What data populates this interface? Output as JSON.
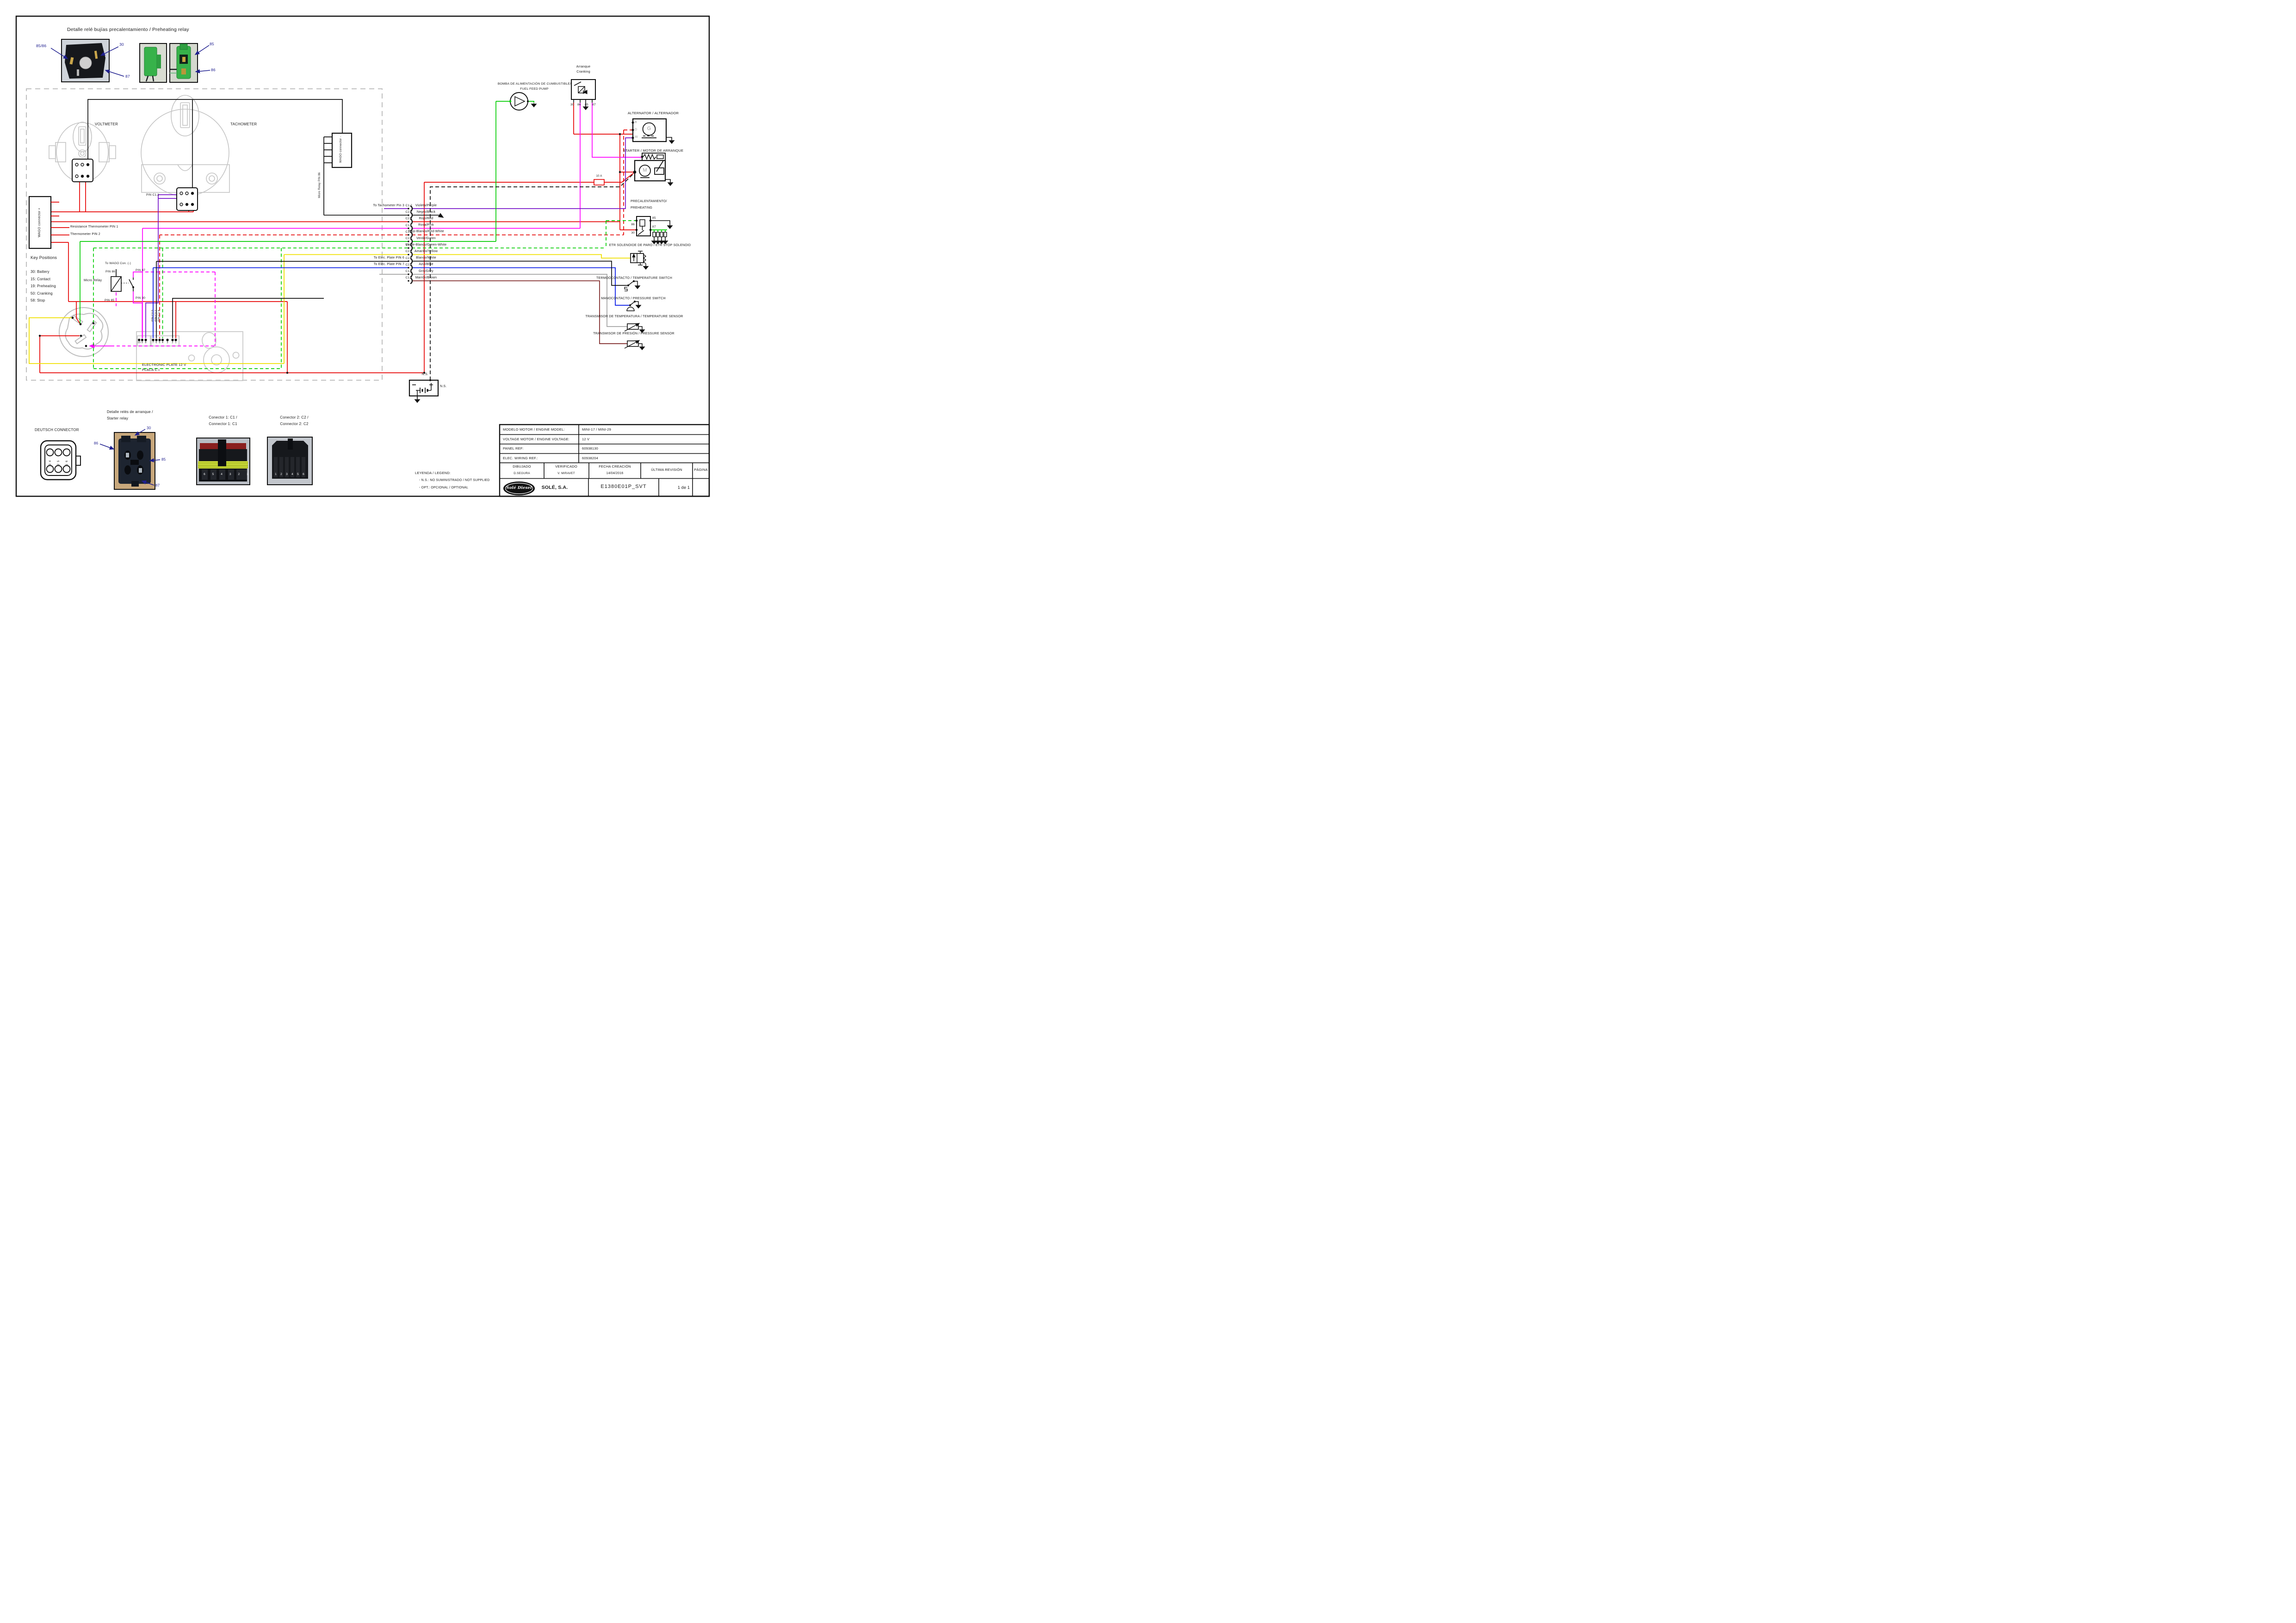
{
  "colors": {
    "red": "#e60000",
    "magenta": "#ff00ff",
    "purple": "#7714c9",
    "green": "#00cc00",
    "yellow": "#f0e000",
    "blue": "#0014e6",
    "grey_wire": "#a3a3a3",
    "brown": "#7b2121",
    "black": "#111111",
    "label_blue": "#1f1f8f",
    "gauge_grey": "#c4c4c4"
  },
  "preheat_detail": {
    "title": "Detalle relé bujías precalentamiento / Preheating relay",
    "lbl_8586": "85/86",
    "lbl_30": "30",
    "lbl_87": "87",
    "lbl_85": "85",
    "lbl_86": "86"
  },
  "panel": {
    "voltmeter": "VOLTMETER",
    "tachometer": "TACHOMETER",
    "wago_plus": "WAGO connector +",
    "wago_minus": "WAGO connector -",
    "micro_relay_pin86": "Micro Relay PIN 86",
    "pin_c12": "PIN C1.2",
    "resistance_thermometer": "Resistance Thermometer PIN 1",
    "thermometer": "Thermometer PIN 2",
    "key_positions": {
      "title": "Key Positions",
      "items": [
        "30: Battery",
        "15: Contact",
        "19: Preheating",
        "50: Cranking",
        "58: Stop"
      ]
    },
    "micro_relay": {
      "label": "Micro Relay",
      "to_wago": "To WAGO Con. (-)",
      "pin86": "PIN 86",
      "pin87": "PIN 87",
      "pin85": "PIN 85",
      "pin30": "PIN 30"
    },
    "plate": {
      "line1": "ELECTRONIC PLATE 12 V",
      "line2": "PLACA C.I.",
      "pin_labels": [
        "PIN C2.5",
        "PIN C2.1",
        "PIN C1.4"
      ],
      "pins_left": [
        "10",
        "9",
        "8"
      ],
      "pins_right": [
        "7",
        "6",
        "5",
        "4",
        "3",
        "2",
        "1"
      ]
    }
  },
  "wires": [
    {
      "code": "C1.2",
      "name": "Violeta/Purple",
      "left_label": "To Tachometer Pin 3",
      "color": "#7714c9"
    },
    {
      "code": "C2.2",
      "name": "Negro/Black",
      "color": "#111111"
    },
    {
      "code": "C2.4",
      "name": "Rojo/Red",
      "color": "#e60000"
    },
    {
      "code": "C1.1",
      "name": "Rosa/Pink",
      "color": "#ff00ff"
    },
    {
      "code": "C1.4",
      "name": "Rojo-Blanco/Red-White",
      "color": "#e60000",
      "dashed": true
    },
    {
      "code": "C2.6",
      "name": "Verde/Green",
      "color": "#00cc00"
    },
    {
      "code": "C1.6",
      "name": "Verde-Blanco/Green-White",
      "color": "#00cc00",
      "dashed": true
    },
    {
      "code": "C2.3",
      "name": "Amarillo/Yellow",
      "color": "#f0e000"
    },
    {
      "code": "C2.1",
      "name": "Blanco/White",
      "left_label": "To Elec. Plate PIN 6",
      "color": "#111111"
    },
    {
      "code": "C2.5",
      "name": "Azul/Blue",
      "left_label": "To Elec. Plate PIN 7",
      "color": "#0014e6"
    },
    {
      "code": "C1.5",
      "name": "Gris/Grey",
      "color": "#a3a3a3"
    },
    {
      "code": "C1.3",
      "name": "Marrón/Brown",
      "color": "#7b2121"
    }
  ],
  "right": {
    "fuel_pump": {
      "l1": "BOMBA DE ALIMENTACIÓN DE CUMBUSTIBLE/",
      "l2": "FUEL FEED PUMP"
    },
    "cranking": {
      "l1": "Arranque",
      "l2": "Cranking",
      "p30": "30",
      "p86": "86",
      "p85": "85",
      "p87": "87"
    },
    "alternator": {
      "title": "ALTERNATOR / ALTERNADOR",
      "tb": "B",
      "td": "D",
      "tw": "W",
      "g": "G"
    },
    "starter": {
      "title": "STARTER / MOTOR DE ARRANQUE",
      "m": "M",
      "fuse": "10 A"
    },
    "preheating": {
      "l1": "PRECALENTAMIENTO/",
      "l2": "PREHEATING",
      "p85": "85",
      "p87": "87",
      "p86": "86",
      "p30": "30"
    },
    "etr": {
      "title": "ETR SOLENOIDE DE PARO / ETR STOP SOLENOID"
    },
    "temp_switch": {
      "title": "TERMOOCONTACTO / TEMPERATURE SWITCH"
    },
    "pressure_switch": {
      "title": "MANOCONTACTO / PRESSURE SWITCH"
    },
    "temp_sensor": {
      "title": "TRANSMISOR DE TEMPERATURA / TEMPERATURE SENSOR"
    },
    "pressure_sensor": {
      "title": "TRANSMISOR DE PRESIÓN / PRESSURE SENSOR"
    },
    "battery": {
      "ns1": "N.S.",
      "ns2": "N.S.",
      "minus": "-",
      "plus": "+"
    }
  },
  "bottom": {
    "deutsch": {
      "title": "DEUTSCH CONNECTOR",
      "pins_top": [
        "4",
        "5",
        "6"
      ],
      "pins_bottom": [
        "3",
        "2",
        "1"
      ]
    },
    "starter_relay": {
      "t1": "Detalle relés de arranque /",
      "t2": "Starter relay",
      "l30": "30",
      "l86": "86",
      "l85": "85",
      "l87": "87"
    },
    "c1": {
      "t1": "Conector 1: C1 /",
      "t2": "Connector 1: C1",
      "pins": [
        "6",
        "5",
        "4",
        "3",
        "2",
        "1"
      ]
    },
    "c2": {
      "t1": "Conector 2: C2 /",
      "t2": "Connector 2: C2",
      "pins": [
        "1",
        "2",
        "3",
        "4",
        "5",
        "6"
      ]
    },
    "legend": {
      "title": "LEYENDA / LEGEND:",
      "i1": "- N.S.: NO SUMINISTRADO / NOT SUPPLIED",
      "i2": "- OPT.: OPCIONAL / OPTIONAL"
    }
  },
  "table": {
    "r1l": "MODELO MOTOR / ENGINE MODEL:",
    "r1v": "MINI-17 / MINI-29",
    "r2l": "VOLTAGE MOTOR / ENGINE VOLTAGE:",
    "r2v": "12 V",
    "r3l": "PANEL REF:",
    "r3v": "60938130",
    "r4l": "ELEC. WIRING REF.:",
    "r4v": "60938204",
    "h1": "DIBUJADO",
    "v1": "D.SEGURA",
    "h2": "VERIFICADO",
    "v2": "V. MIRAVET",
    "h3": "FECHA CREACIÓN",
    "v3": "14/04/2016",
    "h4": "ÚLTIMA REVISIÓN",
    "h5": "PÁGINA",
    "logo": "Solé Diesel",
    "brand": "SOLÉ, S.A.",
    "code": "E1380E01P_SVT",
    "page": "1 de 1"
  }
}
